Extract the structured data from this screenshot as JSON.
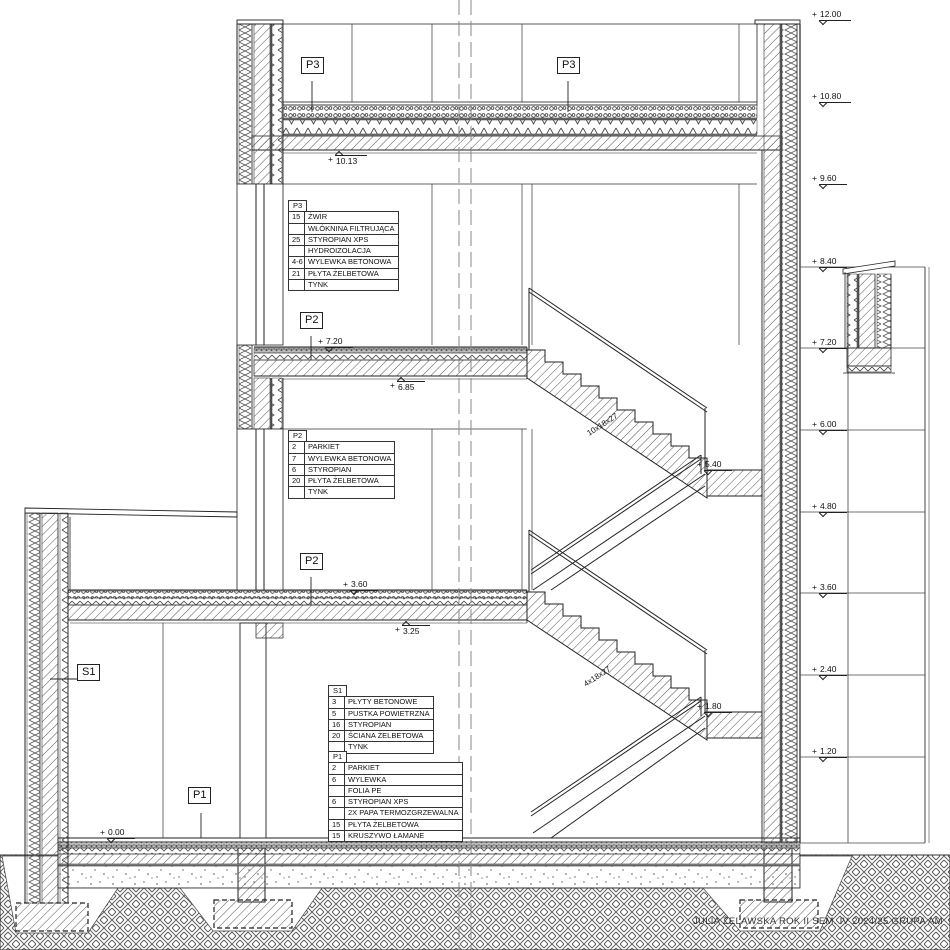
{
  "drawing": {
    "title": "JULIA ŻELAWSKA ROK II SEM. IV 2024/25 GRUPA AM"
  },
  "legend_tables": {
    "p3": {
      "id": "P3",
      "rows": [
        [
          "15",
          "ŻWIR"
        ],
        [
          "",
          "WŁÓKNINA FILTRUJĄCA"
        ],
        [
          "25",
          "STYROPIAN XPS"
        ],
        [
          "",
          "HYDROIZOLACJA"
        ],
        [
          "4-6",
          "WYLEWKA BETONOWA"
        ],
        [
          "21",
          "PŁYTA ŻELBETOWA"
        ],
        [
          "",
          "TYNK"
        ]
      ]
    },
    "p2": {
      "id": "P2",
      "rows": [
        [
          "2",
          "PARKIET"
        ],
        [
          "7",
          "WYLEWKA BETONOWA"
        ],
        [
          "6",
          "STYROPIAN"
        ],
        [
          "20",
          "PŁYTA ŻELBETOWA"
        ],
        [
          "",
          "TYNK"
        ]
      ]
    },
    "s1": {
      "id": "S1",
      "rows": [
        [
          "3",
          "PŁYTY BETONOWE"
        ],
        [
          "5",
          "PUSTKA POWIETRZNA"
        ],
        [
          "16",
          "STYROPIAN"
        ],
        [
          "20",
          "ŚCIANA ŻELBETOWA"
        ],
        [
          "",
          "TYNK"
        ]
      ]
    },
    "p1": {
      "id": "P1",
      "rows": [
        [
          "2",
          "PARKIET"
        ],
        [
          "6",
          "WYLEWKA"
        ],
        [
          "",
          "FOLIA PE"
        ],
        [
          "6",
          "STYROPIAN XPS"
        ],
        [
          "",
          "2X PAPA TERMOZGRZEWALNA"
        ],
        [
          "15",
          "PŁYTA ŻELBETOWA"
        ],
        [
          "15",
          "KRUSZYWO ŁAMANE"
        ]
      ]
    }
  },
  "section_tags": {
    "p3_left": "P3",
    "p3_right": "P3",
    "p2_upper": "P2",
    "p2_lower": "P2",
    "s1": "S1",
    "p1": "P1"
  },
  "stairs": {
    "upper_flight": "10x18x27",
    "lower_flight": "4x18x27"
  },
  "elevation_markers": {
    "right": [
      {
        "sign": "+",
        "value": "12.00",
        "x": 812,
        "y": 10,
        "dir": "down"
      },
      {
        "sign": "+",
        "value": "10.80",
        "x": 812,
        "y": 92,
        "dir": "down"
      },
      {
        "sign": "+",
        "value": "9.60",
        "x": 812,
        "y": 174,
        "dir": "down"
      },
      {
        "sign": "+",
        "value": "8.40",
        "x": 812,
        "y": 257,
        "dir": "down"
      },
      {
        "sign": "+",
        "value": "7.20",
        "x": 812,
        "y": 338,
        "dir": "down"
      },
      {
        "sign": "+",
        "value": "6.00",
        "x": 812,
        "y": 420,
        "dir": "down"
      },
      {
        "sign": "+",
        "value": "4.80",
        "x": 812,
        "y": 502,
        "dir": "down"
      },
      {
        "sign": "+",
        "value": "3.60",
        "x": 812,
        "y": 583,
        "dir": "down"
      },
      {
        "sign": "+",
        "value": "2.40",
        "x": 812,
        "y": 665,
        "dir": "down"
      },
      {
        "sign": "+",
        "value": "1.20",
        "x": 812,
        "y": 747,
        "dir": "down"
      }
    ],
    "inline": [
      {
        "sign": "+",
        "value": "10.13",
        "x": 328,
        "y": 152,
        "dir": "up"
      },
      {
        "sign": "+",
        "value": "7.20",
        "x": 318,
        "y": 337,
        "dir": "down"
      },
      {
        "sign": "+",
        "value": "6.85",
        "x": 390,
        "y": 378,
        "dir": "up"
      },
      {
        "sign": "+",
        "value": "3.60",
        "x": 343,
        "y": 580,
        "dir": "down"
      },
      {
        "sign": "+",
        "value": "3.25",
        "x": 395,
        "y": 622,
        "dir": "up"
      },
      {
        "sign": "+",
        "value": "5.40",
        "x": 697,
        "y": 460,
        "dir": "down"
      },
      {
        "sign": "+",
        "value": "1.80",
        "x": 697,
        "y": 702,
        "dir": "down"
      },
      {
        "sign": "+",
        "value": "0.00",
        "x": 100,
        "y": 828,
        "dir": "down"
      }
    ]
  },
  "colors": {
    "line": "#222222",
    "hatch": "#555555",
    "ground_hatch": "#555555",
    "centerline": "#888888",
    "background": "#ffffff"
  }
}
